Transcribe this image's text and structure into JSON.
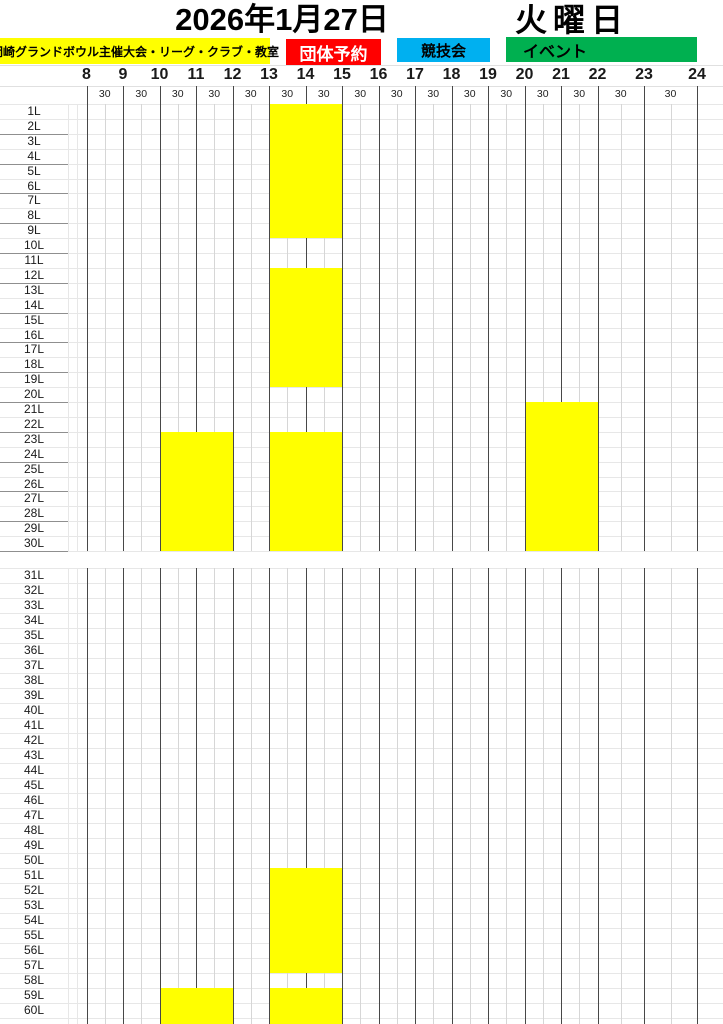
{
  "header": {
    "date": "2026年1月27日",
    "day": "火曜日"
  },
  "legend": {
    "items": [
      {
        "id": "host-events",
        "label": "岡崎グランドボウル主催大会・リーグ・クラブ・教室",
        "color": "#FFFF00",
        "text_color": "#000000"
      },
      {
        "id": "group-reservation",
        "label": "団体予約",
        "color": "#FF0000",
        "text_color": "#FFFFFF"
      },
      {
        "id": "competition",
        "label": "競技会",
        "color": "#00B0F0",
        "text_color": "#000000"
      },
      {
        "id": "event",
        "label": "イベント",
        "color": "#00B050",
        "text_color": "#000000"
      }
    ]
  },
  "time_axis": {
    "hours": [
      8,
      9,
      10,
      11,
      12,
      13,
      14,
      15,
      16,
      17,
      18,
      19,
      20,
      21,
      22,
      23,
      24
    ],
    "half_hour_label": "30"
  },
  "lanes": {
    "top_first": 1,
    "top_last": 30,
    "bottom_first": 31,
    "bottom_last": 60,
    "suffix": "L"
  },
  "chart_data": {
    "type": "heatmap",
    "title": "2026年1月27日 火曜日",
    "xlabel": "時刻",
    "x_range": [
      8,
      24
    ],
    "x_tick_labels": [
      "8",
      "9",
      "10",
      "11",
      "12",
      "13",
      "14",
      "15",
      "16",
      "17",
      "18",
      "19",
      "20",
      "21",
      "22",
      "23",
      "24"
    ],
    "y_categories_top": [
      "1L",
      "2L",
      "3L",
      "4L",
      "5L",
      "6L",
      "7L",
      "8L",
      "9L",
      "10L",
      "11L",
      "12L",
      "13L",
      "14L",
      "15L",
      "16L",
      "17L",
      "18L",
      "19L",
      "20L",
      "21L",
      "22L",
      "23L",
      "24L",
      "25L",
      "26L",
      "27L",
      "28L",
      "29L",
      "30L"
    ],
    "y_categories_bottom": [
      "31L",
      "32L",
      "33L",
      "34L",
      "35L",
      "36L",
      "37L",
      "38L",
      "39L",
      "40L",
      "41L",
      "42L",
      "43L",
      "44L",
      "45L",
      "46L",
      "47L",
      "48L",
      "49L",
      "50L",
      "51L",
      "52L",
      "53L",
      "54L",
      "55L",
      "56L",
      "57L",
      "58L",
      "59L",
      "60L"
    ],
    "grid": "hour lines dark, half-hour lines light",
    "legend_position": "top",
    "blocks": [
      {
        "lanes": "1L-9L",
        "lane_from": 1,
        "lane_to": 9,
        "hour_from": 13,
        "hour_to": 15,
        "category": "岡崎グランドボウル主催大会・リーグ・クラブ・教室",
        "color": "#FFFF00",
        "extend_to_bottom": false
      },
      {
        "lanes": "12L-19L",
        "lane_from": 12,
        "lane_to": 19,
        "hour_from": 13,
        "hour_to": 15,
        "category": "岡崎グランドボウル主催大会・リーグ・クラブ・教室",
        "color": "#FFFF00",
        "extend_to_bottom": false
      },
      {
        "lanes": "21L-30L",
        "lane_from": 21,
        "lane_to": 30,
        "hour_from": 20,
        "hour_to": 22,
        "category": "岡崎グランドボウル主催大会・リーグ・クラブ・教室",
        "color": "#FFFF00",
        "extend_to_bottom": false
      },
      {
        "lanes": "23L-30L",
        "lane_from": 23,
        "lane_to": 30,
        "hour_from": 10,
        "hour_to": 12,
        "category": "岡崎グランドボウル主催大会・リーグ・クラブ・教室",
        "color": "#FFFF00",
        "extend_to_bottom": false
      },
      {
        "lanes": "23L-30L",
        "lane_from": 23,
        "lane_to": 30,
        "hour_from": 13,
        "hour_to": 15,
        "category": "岡崎グランドボウル主催大会・リーグ・クラブ・教室",
        "color": "#FFFF00",
        "extend_to_bottom": false
      },
      {
        "lanes": "51L-57L",
        "lane_from": 51,
        "lane_to": 57,
        "hour_from": 13,
        "hour_to": 15,
        "category": "岡崎グランドボウル主催大会・リーグ・クラブ・教室",
        "color": "#FFFF00",
        "extend_to_bottom": false
      },
      {
        "lanes": "59L-60L",
        "lane_from": 59,
        "lane_to": 60,
        "hour_from": 10,
        "hour_to": 12,
        "category": "岡崎グランドボウル主催大会・リーグ・クラブ・教室",
        "color": "#FFFF00",
        "extend_to_bottom": true
      },
      {
        "lanes": "59L-60L",
        "lane_from": 59,
        "lane_to": 60,
        "hour_from": 13,
        "hour_to": 15,
        "category": "岡崎グランドボウル主催大会・リーグ・クラブ・教室",
        "color": "#FFFF00",
        "extend_to_bottom": true
      }
    ]
  }
}
